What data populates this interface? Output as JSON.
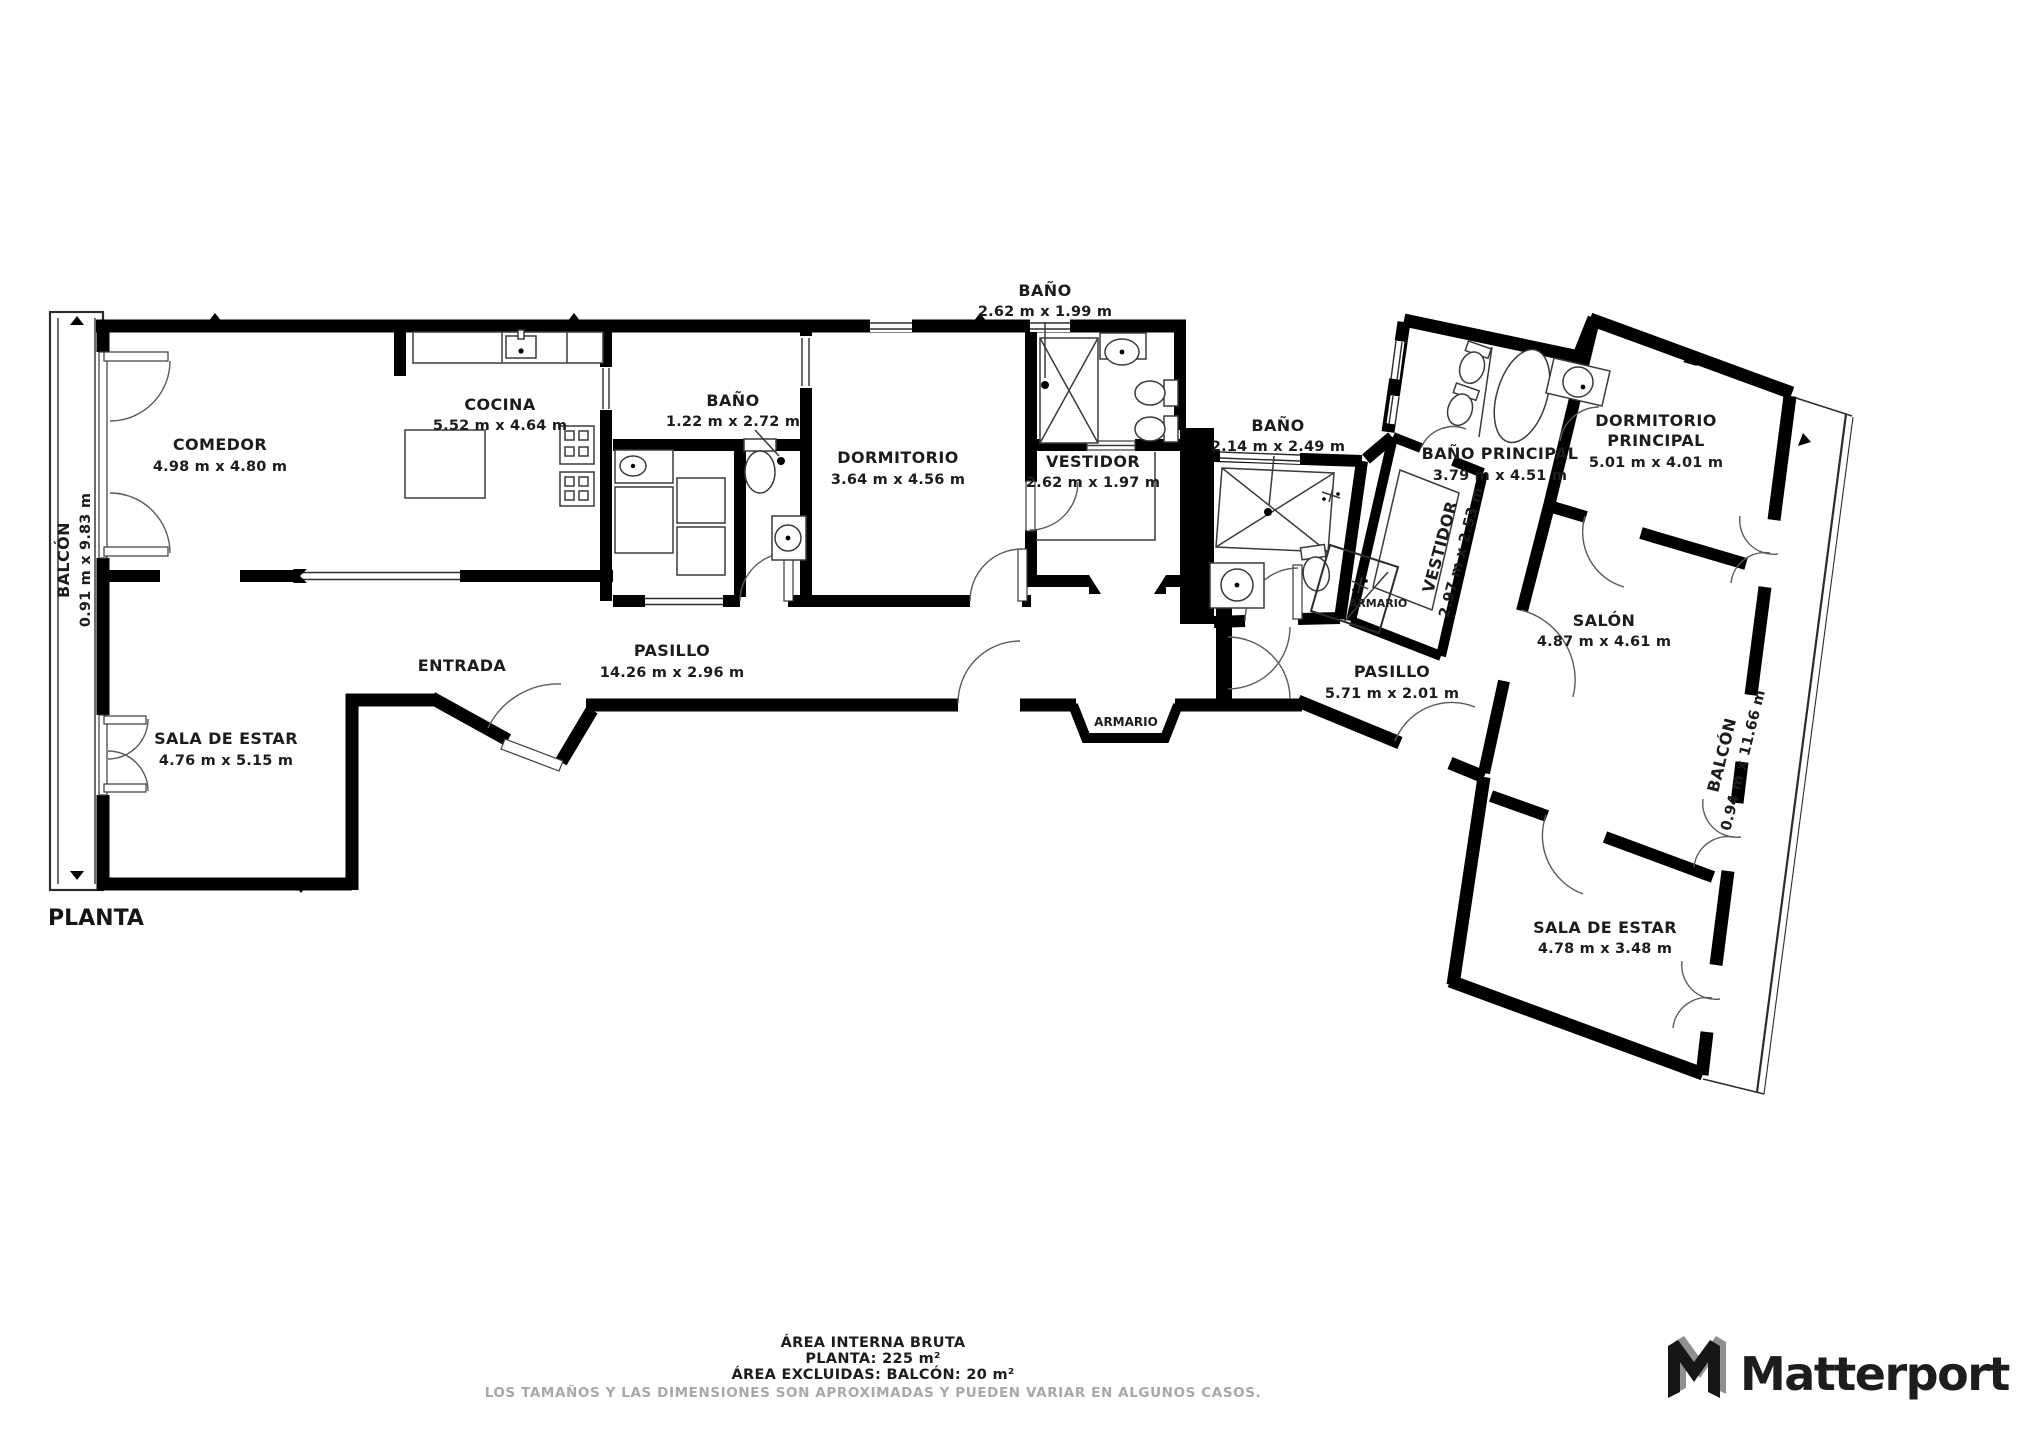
{
  "plan": {
    "title": "PLANTA",
    "rooms": [
      {
        "id": "balcon-izquierdo",
        "name": "BALCÓN",
        "dims": "0.91 m x 9.83 m"
      },
      {
        "id": "comedor",
        "name": "COMEDOR",
        "dims": "4.98 m x 4.80 m"
      },
      {
        "id": "cocina",
        "name": "COCINA",
        "dims": "5.52 m x 4.64 m"
      },
      {
        "id": "bano-cocina",
        "name": "BAÑO",
        "dims": "1.22 m x 2.72 m"
      },
      {
        "id": "sala-de-estar-izquierda",
        "name": "SALA DE ESTAR",
        "dims": "4.76 m x 5.15 m"
      },
      {
        "id": "entrada",
        "name": "ENTRADA"
      },
      {
        "id": "pasillo",
        "name": "PASILLO",
        "dims": "14.26 m x 2.96 m"
      },
      {
        "id": "armario-pasillo",
        "name": "ARMARIO"
      },
      {
        "id": "dormitorio",
        "name": "DORMITORIO",
        "dims": "3.64 m x 4.56 m"
      },
      {
        "id": "bano-dormitorio",
        "name": "BAÑO",
        "dims": "2.62 m x 1.99 m"
      },
      {
        "id": "vestidor",
        "name": "VESTIDOR",
        "dims": "2.62 m x 1.97 m"
      },
      {
        "id": "bano-central",
        "name": "BAÑO",
        "dims": "2.14 m x 2.49 m"
      },
      {
        "id": "armario-central",
        "name": "ARMARIO"
      },
      {
        "id": "pasillo-2",
        "name": "PASILLO",
        "dims": "5.71 m x 2.01 m"
      },
      {
        "id": "bano-principal",
        "name": "BAÑO PRINCIPAL",
        "dims": "3.79 m x 4.51 m"
      },
      {
        "id": "vestidor-principal",
        "name": "VESTIDOR",
        "dims": "2.97 m x 2.53 m"
      },
      {
        "id": "dormitorio-principal",
        "name": "DORMITORIO PRINCIPAL",
        "name_line1": "DORMITORIO",
        "name_line2": "PRINCIPAL",
        "dims": "5.01 m x 4.01 m"
      },
      {
        "id": "salon",
        "name": "SALÓN",
        "dims": "4.87 m x 4.61 m"
      },
      {
        "id": "sala-de-estar-derecha",
        "name": "SALA DE ESTAR",
        "dims": "4.78 m x 3.48 m"
      },
      {
        "id": "balcon-derecho",
        "name": "BALCÓN",
        "dims": "0.94 m x 11.66 m"
      }
    ],
    "footer": {
      "line1": "ÁREA INTERNA BRUTA",
      "line2": "PLANTA: 225 m²",
      "line3": "ÁREA EXCLUIDAS: BALCÓN: 20 m²",
      "disclaimer": "LOS TAMAÑOS Y LAS DIMENSIONES SON APROXIMADAS Y PUEDEN VARIAR EN ALGUNOS CASOS."
    },
    "brand": {
      "name": "Matterport"
    },
    "colors": {
      "wall": "#000000",
      "line": "#3a3a3a",
      "text": "#1c1c1c",
      "muted": "#a8a8a8",
      "background": "#ffffff"
    }
  }
}
